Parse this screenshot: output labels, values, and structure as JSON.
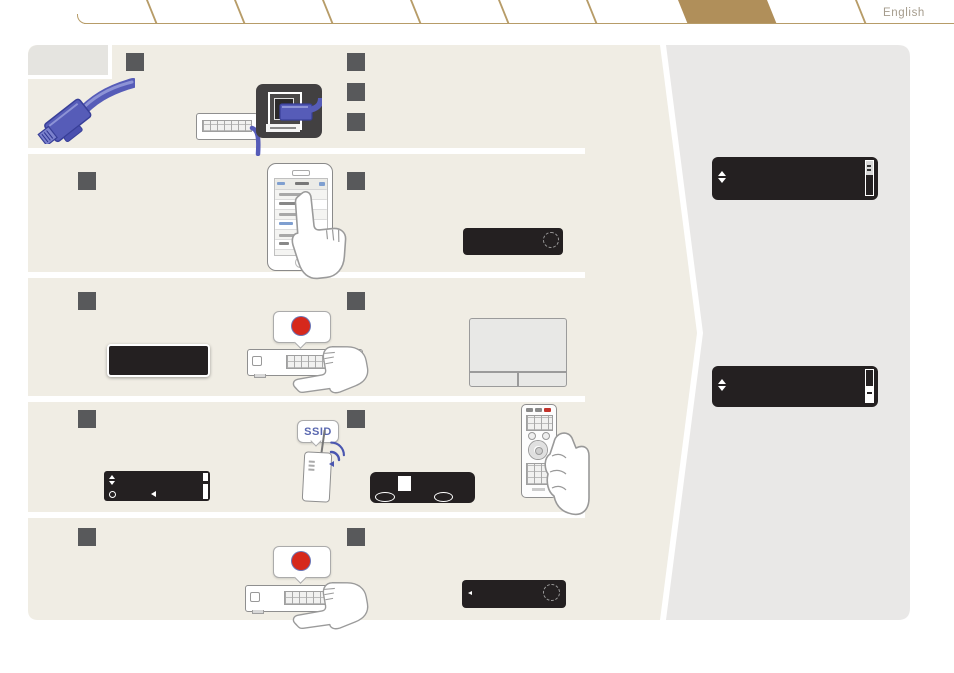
{
  "page": {
    "language_label": "English",
    "background": "#ffffff"
  },
  "tabbar": {
    "tab_count": 9,
    "active_tab_index": 7,
    "line_color": "#b79c68",
    "active_fill": "#b08f5a",
    "note": "row of slanted blank index tabs across the top edge"
  },
  "card": {
    "background": "#f0ede4",
    "corner_label_background": "#e5e4e0",
    "row_count": 5,
    "step_marker_color": "#58595b",
    "step_markers_per_row": [
      4,
      2,
      2,
      2,
      2
    ]
  },
  "side_panel": {
    "background": "#e9e8e7",
    "displays": [
      {
        "icons": [
          "scroll-updown-arrows",
          "scrollbar-thumb-top"
        ]
      },
      {
        "icons": [
          "scroll-updown-arrows",
          "scrollbar-thumb-top"
        ]
      }
    ]
  },
  "artwork": {
    "ssid_bubble_label": "SSID",
    "record_button_color": "#d6281c",
    "cable_color": "#565cb8",
    "display_color": "#242021",
    "icons": {
      "updown-arrows": "▲▼",
      "cursor-left": "◀",
      "record-dot": "●",
      "blinking-status-circle": "◌ (dashed circle)",
      "wifi-signal": "three blue arcs"
    },
    "scenes": [
      "ethernet cable and rear LAN port close-up",
      "smartphone wi-fi setup screen tapped by hand",
      "front-panel button press (red dot callout) and router table",
      "router broadcasting SSID, text-entry display, remote control in hand",
      "front-panel button press (red dot callout) and blinking display"
    ]
  }
}
